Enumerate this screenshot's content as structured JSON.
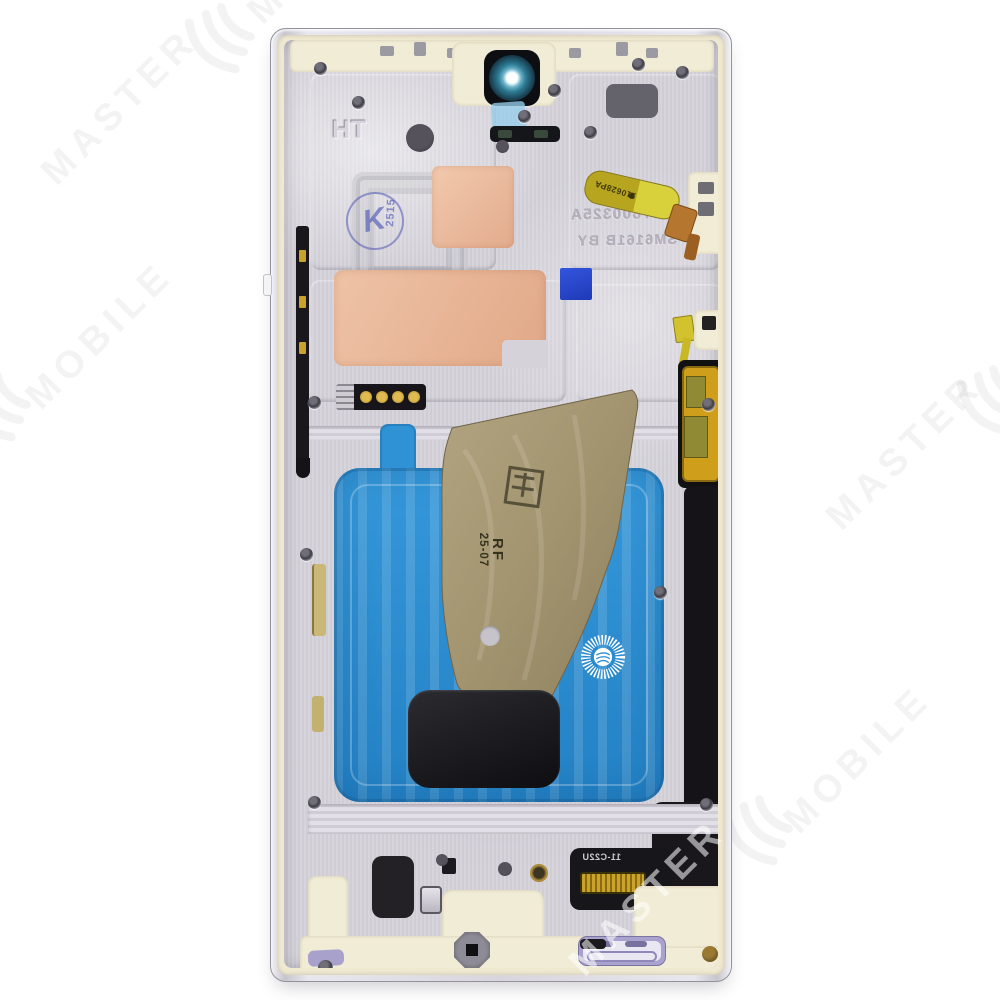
{
  "scene": {
    "type": "product-photo",
    "subject": "smartphone-midframe-front-housing",
    "background_color": "#ffffff"
  },
  "watermark": {
    "color_on_white": "rgba(100,100,110,0.075)",
    "color_on_device": "rgba(255,255,255,0.55)",
    "logo_name": "master-mobile-leaf-logo",
    "tiles": [
      {
        "text": "MASTER"
      },
      {
        "text": "MOBILE"
      },
      {
        "text": "MASTER"
      },
      {
        "text": "MOBILE"
      },
      {
        "text": "MASTER"
      },
      {
        "text": "M"
      }
    ]
  },
  "device": {
    "markings": {
      "embossed_code": "HT",
      "ink_stamp_letter": "K",
      "ink_stamp_number": "2515",
      "etched_line1": "HT800325A",
      "etched_line2": "SM6161B BY",
      "flex_code": "110628PA",
      "bronze_stamp_rf": "RF",
      "bronze_stamp_date": "25-07",
      "bottom_connector_code": "11-C22U"
    },
    "colors": {
      "rail_silver": "#d8d5dd",
      "lip_cream": "#efe9d2",
      "plate_silver": "#d5d2da",
      "adhesive_blue": "#2a8ed2",
      "bronze_plate": "#a2946f",
      "thermal_pad_copper": "#ecbda1",
      "flex_yellow": "#d3c326",
      "sticker_blue": "#2746cc",
      "speaker_lavender": "#a9a2cf",
      "camera_ring_teal": "#2e7d96",
      "graphite_black": "#1d1c20",
      "ink_stamp_blue": "#424cb0"
    }
  }
}
